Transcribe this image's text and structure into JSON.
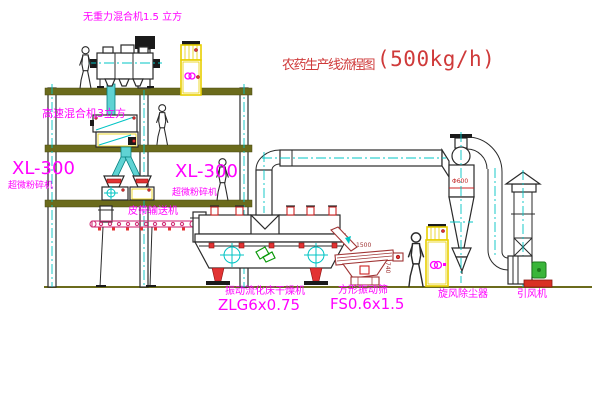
{
  "title": {
    "name": "农药生产线流程图",
    "capacity": "(500kg/h)"
  },
  "labels": {
    "gravity_mixer": "无重力混合机1.5 立方",
    "high_speed_mixer": "高速混合机3立方",
    "mill_left_model": "XL-300",
    "mill_left_name": "超微粉碎机",
    "mill_mid_model": "XL-300",
    "mill_mid_name": "超微粉碎机",
    "belt_conveyor": "皮带输送机",
    "dryer_name": "振动流化床干燥机",
    "dryer_model": "ZLG6x0.75",
    "sieve_name": "方形振动筛",
    "sieve_model": "FS0.6x1.5",
    "cyclone": "旋风除尘器",
    "fan": "引风机"
  },
  "dimensions": {
    "cyclone_diameter": "Φ600",
    "sieve_length": "1500",
    "sieve_height": "740"
  },
  "colors": {
    "label_magenta": "#ff00ff",
    "title_red": "#cf3a3a",
    "structure_olive": "#6b6b1c",
    "centerline_cyan": "#00c4c4",
    "cabinet_yellow": "#e8cf00",
    "machine_red": "#e23333",
    "fan_green": "#3ab53a",
    "sieve_darkred": "#a03434"
  }
}
